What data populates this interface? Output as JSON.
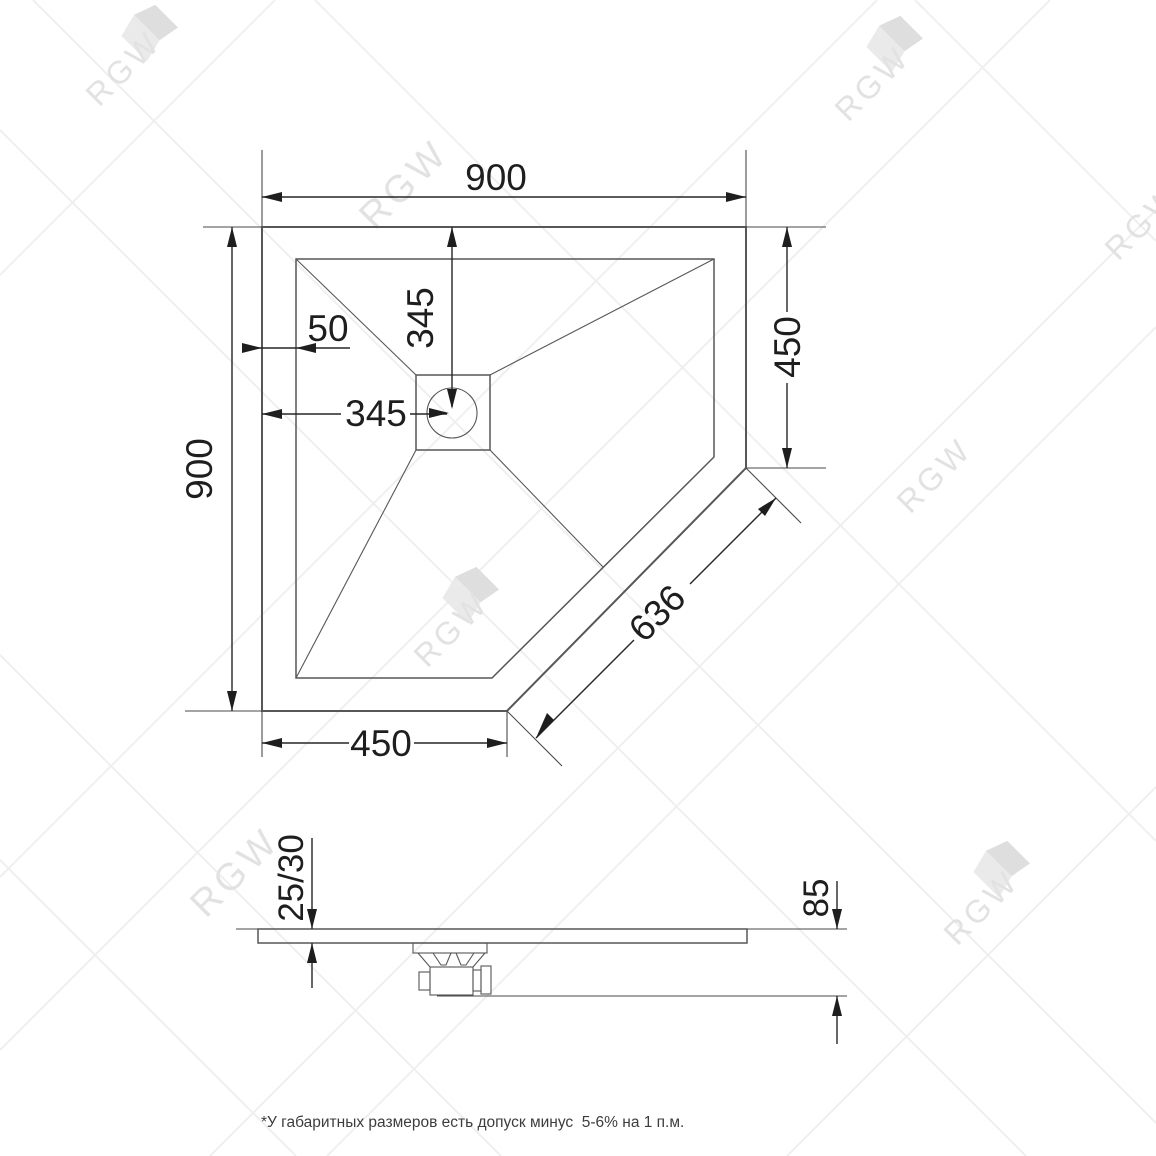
{
  "drawing": {
    "top_view": {
      "overall_width": "900",
      "overall_depth": "900",
      "right_side": "450",
      "bottom_side": "450",
      "chamfer_edge": "636",
      "drain_offset_from_left": "345",
      "drain_offset_from_top": "345",
      "rim_offset": "50"
    },
    "side_view": {
      "tray_thickness": "25/30",
      "total_height": "85"
    }
  },
  "watermark": {
    "brand": "RGW"
  },
  "footer": {
    "tolerance_note": "*У габаритных размеров есть допуск минус  5-6% на 1 п.м."
  },
  "colors": {
    "background": "#ffffff",
    "outline": "#575757",
    "dimension": "#262626",
    "dimension_text": "#1e1e1e",
    "watermark_line": "#efefef",
    "watermark_text": "#e2e2e2",
    "footer_text": "#3d3d3d"
  }
}
